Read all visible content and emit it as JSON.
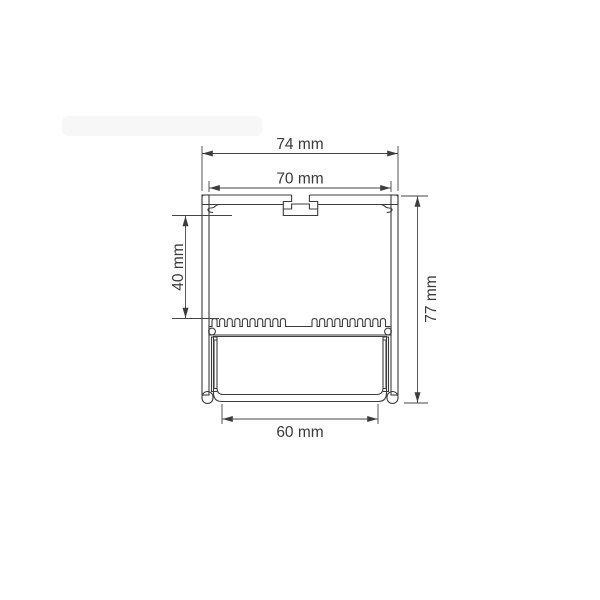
{
  "drawing": {
    "subject": "aluminium-led-profile-cross-section",
    "background": "#ffffff",
    "line_color": "#3d3d3d",
    "hatch_color": "#555555",
    "dimensions": {
      "outer_width": "74 mm",
      "mounting_width": "70 mm",
      "upper_chamber_height": "40 mm",
      "overall_height": "77 mm",
      "diffuser_width": "60 mm"
    }
  }
}
